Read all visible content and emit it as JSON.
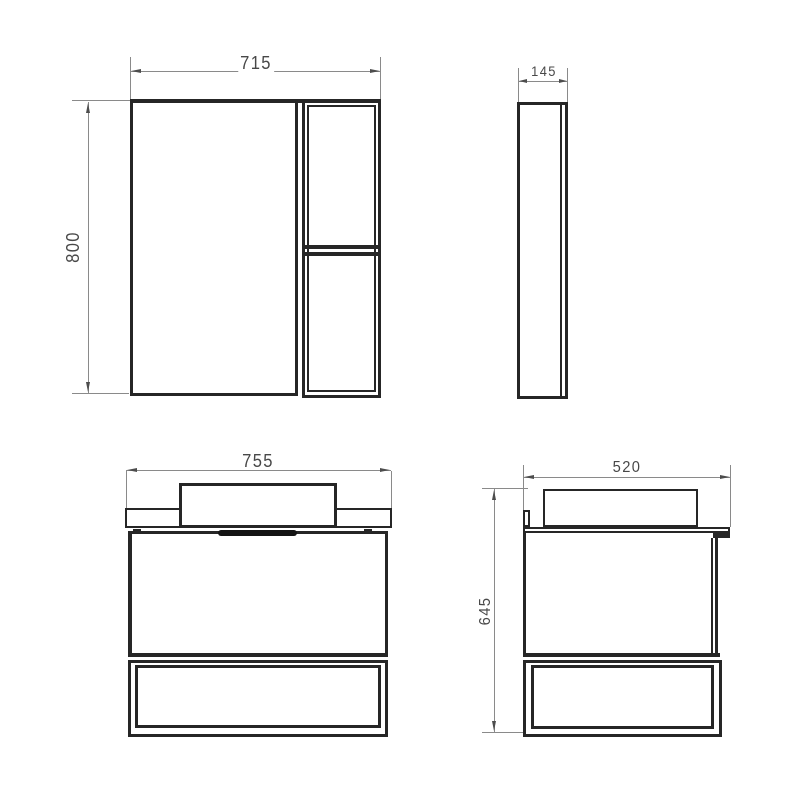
{
  "drawing": {
    "type": "technical-dimension-drawing",
    "subject": "bathroom furniture set (mirror cabinet and vanity unit), four orthographic views",
    "background": "#ffffff",
    "line_color": "#262626",
    "dim_line_color": "#8a8a8a",
    "text_color": "#484848",
    "views": {
      "mirror_front": {
        "name": "mirror-cabinet-front-view",
        "width": "715",
        "height": "800"
      },
      "mirror_side": {
        "name": "mirror-cabinet-side-view",
        "depth": "145"
      },
      "vanity_front": {
        "name": "vanity-unit-front-view",
        "width": "755"
      },
      "vanity_side": {
        "name": "vanity-unit-side-view",
        "depth": "520",
        "height": "645"
      }
    }
  }
}
